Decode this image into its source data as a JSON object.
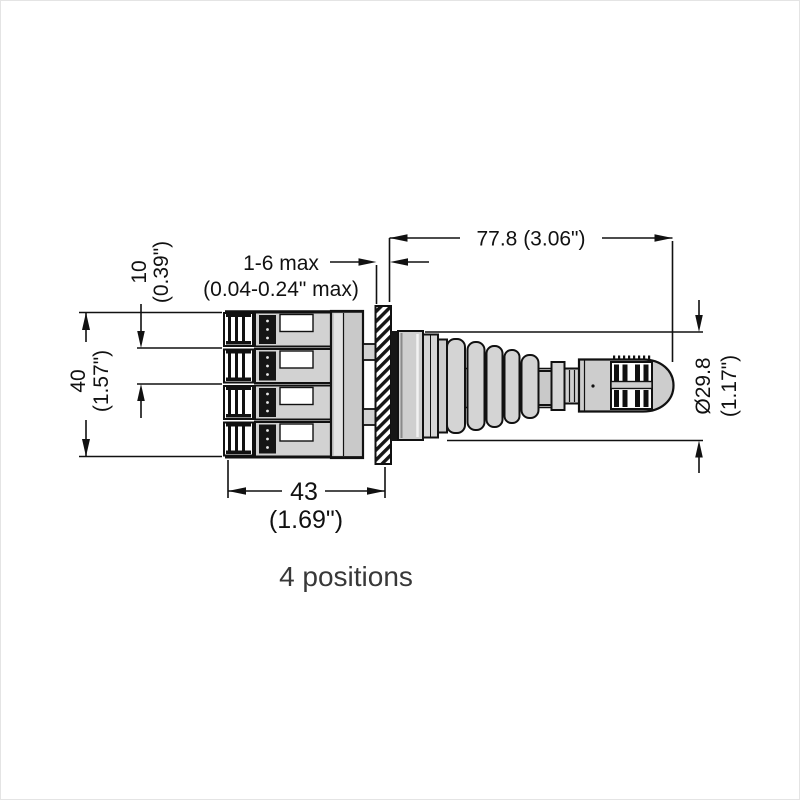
{
  "drawing": {
    "caption": "4 positions",
    "dims": {
      "length": "77.8 (3.06\")",
      "panel_range": "1-6 max",
      "panel_range_in": "(0.04-0.24\" max)",
      "pitch": "10",
      "pitch_in": "(0.39\")",
      "height": "40",
      "height_in": "(1.57\")",
      "width": "43",
      "width_in": "(1.69\")",
      "diameter": "Ø29.8",
      "diameter_in": "(1.17\")"
    }
  }
}
